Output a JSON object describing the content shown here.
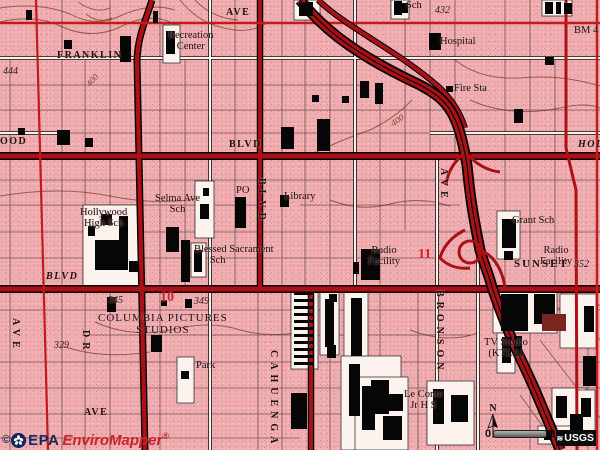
{
  "colors": {
    "urban_pink": "#f2adb1",
    "road_red": "#ae1115",
    "overlay_red": "#d62128",
    "contour_brown": "#8a4c35",
    "epa_navy": "#16275c",
    "epa_red": "#cc2229"
  },
  "watermark": {
    "copyright": "©",
    "org": "EPA",
    "product": "EnviroMapper",
    "registered": "®"
  },
  "north_arrow": {
    "label": "N"
  },
  "scale_bar": {
    "start": "0",
    "end": "0"
  },
  "usgs": {
    "label": "USGS",
    "wave_icon": "≋"
  },
  "map_labels": [
    {
      "name": "street-franklin",
      "text": "FRANKLIN",
      "x": 57,
      "y": 51,
      "cls": "street"
    },
    {
      "name": "street-ave-top",
      "text": "AVE",
      "x": 226,
      "y": 8,
      "cls": "street"
    },
    {
      "name": "label-recreation-center",
      "text": "Recreation\nCenter",
      "x": 168,
      "y": 30,
      "cls": "place"
    },
    {
      "name": "label-sch-top",
      "text": "Sch",
      "x": 406,
      "y": 0,
      "cls": "place"
    },
    {
      "name": "elev-432",
      "text": "432",
      "x": 435,
      "y": 6,
      "cls": "elev"
    },
    {
      "name": "label-hospital",
      "text": "Hospital",
      "x": 440,
      "y": 36,
      "cls": "place"
    },
    {
      "name": "label-bm-4",
      "text": "BM 4",
      "x": 574,
      "y": 25,
      "cls": "place"
    },
    {
      "name": "label-fire-sta",
      "text": "Fire Sta",
      "x": 454,
      "y": 83,
      "cls": "place"
    },
    {
      "name": "elev-444",
      "text": "444",
      "x": 3,
      "y": 67,
      "cls": "elev"
    },
    {
      "name": "contour-400-west",
      "text": "400",
      "x": 86,
      "y": 76,
      "cls": "contour rot-m50"
    },
    {
      "name": "contour-400-mid",
      "text": "400",
      "x": 391,
      "y": 116,
      "cls": "contour rot-m35"
    },
    {
      "name": "street-ood-left",
      "text": "OOD",
      "x": 0,
      "y": 137,
      "cls": "street"
    },
    {
      "name": "street-blvd-hollywood",
      "text": "BLVD",
      "x": 229,
      "y": 140,
      "cls": "street"
    },
    {
      "name": "street-hol-right",
      "text": "HOL",
      "x": 578,
      "y": 140,
      "cls": "street ital"
    },
    {
      "name": "label-hollywood-high",
      "text": "Hollywood\nHigh Sch",
      "x": 80,
      "y": 207,
      "cls": "place"
    },
    {
      "name": "label-selma-ave-sch",
      "text": "Selma Ave\nSch",
      "x": 155,
      "y": 193,
      "cls": "place"
    },
    {
      "name": "label-po",
      "text": "PO",
      "x": 236,
      "y": 185,
      "cls": "place"
    },
    {
      "name": "label-library",
      "text": "Library",
      "x": 284,
      "y": 191,
      "cls": "place"
    },
    {
      "name": "street-blvd-cahuenga-vert",
      "text": "BLVD",
      "x": 266,
      "y": 178,
      "cls": "street vert"
    },
    {
      "name": "street-ave-bronson-vert",
      "text": "AVE",
      "x": 448,
      "y": 168,
      "cls": "street vert"
    },
    {
      "name": "label-blessed-sacrament",
      "text": "Blessed Sacrament\n      Sch",
      "x": 194,
      "y": 244,
      "cls": "place left2"
    },
    {
      "name": "label-grant-sch",
      "text": "Grant Sch",
      "x": 512,
      "y": 215,
      "cls": "place"
    },
    {
      "name": "label-radio-facility-west",
      "text": "Radio\nFacility",
      "x": 368,
      "y": 245,
      "cls": "place"
    },
    {
      "name": "site-number-11",
      "text": "11",
      "x": 418,
      "y": 248,
      "cls": "site"
    },
    {
      "name": "label-radio-facility-east",
      "text": "Radio\nFacility",
      "x": 540,
      "y": 245,
      "cls": "place"
    },
    {
      "name": "street-blvd-sunset-west",
      "text": "BLVD",
      "x": 46,
      "y": 272,
      "cls": "street ital"
    },
    {
      "name": "street-sunset",
      "text": "SUNSET",
      "x": 514,
      "y": 259,
      "cls": "street wide"
    },
    {
      "name": "elev-352",
      "text": "352",
      "x": 574,
      "y": 260,
      "cls": "elev"
    },
    {
      "name": "elev-345",
      "text": "345",
      "x": 108,
      "y": 296,
      "cls": "elev"
    },
    {
      "name": "site-number-10",
      "text": "10",
      "x": 160,
      "y": 291,
      "cls": "site"
    },
    {
      "name": "elev-349",
      "text": "349",
      "x": 194,
      "y": 297,
      "cls": "elev"
    },
    {
      "name": "elev-329",
      "text": "329",
      "x": 54,
      "y": 341,
      "cls": "elev"
    },
    {
      "name": "street-ave-left-vert",
      "text": "AVE",
      "x": 20,
      "y": 318,
      "cls": "street vert"
    },
    {
      "name": "street-dr-vert",
      "text": "DR",
      "x": 90,
      "y": 330,
      "cls": "street vert"
    },
    {
      "name": "label-columbia-pictures",
      "text": "COLUMBIA PICTURES\nSTUDIOS",
      "x": 98,
      "y": 313,
      "cls": "caps"
    },
    {
      "name": "street-bronson-vert",
      "text": "BRONSON",
      "x": 444,
      "y": 290,
      "cls": "street vert"
    },
    {
      "name": "street-cahuenga-vert",
      "text": "CAHUENGA",
      "x": 278,
      "y": 350,
      "cls": "street vert"
    },
    {
      "name": "label-tv-studio-ktla",
      "text": "TV Studio\n(KTLA)",
      "x": 484,
      "y": 337,
      "cls": "place"
    },
    {
      "name": "label-park",
      "text": "Park",
      "x": 196,
      "y": 360,
      "cls": "place"
    },
    {
      "name": "label-le-conte",
      "text": "Le Conte\nJr H S",
      "x": 404,
      "y": 389,
      "cls": "place"
    },
    {
      "name": "street-ave-bottom-left",
      "text": "AVE",
      "x": 84,
      "y": 408,
      "cls": "street"
    }
  ]
}
